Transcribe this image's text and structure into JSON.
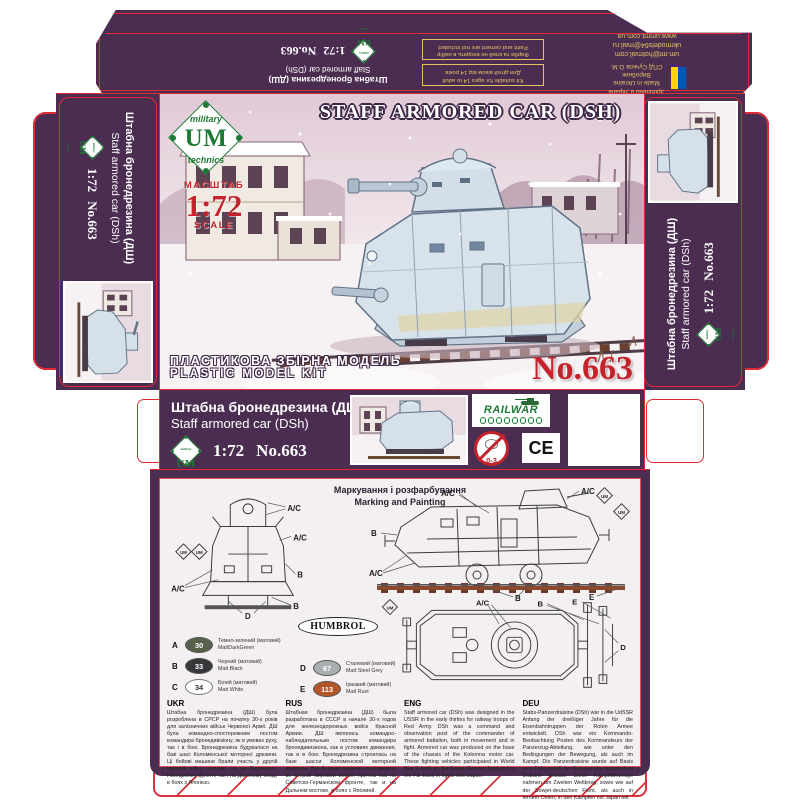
{
  "brand": {
    "military": "military",
    "um": "UM",
    "technics": "technics"
  },
  "top_flap": {
    "title_uk": "Штабна бронедрезина (ДШ)",
    "title_en": "Staff armored car (DSh)",
    "scale": "1:72",
    "kit_no": "No.663",
    "warning_paint_uk": "Фарби та клей не входять в набір",
    "warning_paint_en": "Paint and cement are not included",
    "warning_age_en": "Kit suitable for ages 14 to adult",
    "warning_age_uk": "Для дітей віком від 14 років",
    "email1": "um.mt@hotmail.com",
    "email2": "ukrmodels64@mail.ru",
    "website": "www.ummt.com.ua",
    "made_in_uk": "Зроблено в Україні",
    "made_in_en": "Made in Ukraine",
    "producer_label": "Виробник",
    "producer_name": "СПД Сучков О.М."
  },
  "box_face": {
    "title": "STAFF ARMORED CAR (DSH)",
    "scale_word_uk": "МАСШТАБ",
    "scale": "1:72",
    "scale_word_en": "SCALE",
    "kit_type_uk": "ПЛАСТИКОВА ЗБІРНА МОДЕЛЬ",
    "kit_type_en": "PLASTIC MODEL KIT",
    "kit_no": "No.663"
  },
  "side_panel": {
    "title_uk": "Штабна бронедрезина (ДШ)",
    "title_en": "Staff armored car (DSh)",
    "scale": "1:72",
    "kit_no": "No.663"
  },
  "mid_strip": {
    "title_uk": "Штабна бронедрезина (ДШ)",
    "title_en": "Staff armored car (DSh)",
    "scale": "1:72",
    "kit_no": "No.663",
    "railwar": "RAILWAR",
    "age_mark": "0-3",
    "ce_mark": "CE"
  },
  "marking": {
    "header_uk": "Маркування і розфарбування",
    "header_en": "Marking and Painting",
    "labels": {
      "ac": "A/C",
      "b": "B",
      "d": "D",
      "e": "E"
    },
    "paint_brand": "HUMBROL",
    "colors": [
      {
        "letter": "A",
        "code": "30",
        "hex": "#57624d",
        "name_uk": "Темно-зелений (матовий)",
        "name_en": "MattDarkGreen"
      },
      {
        "letter": "B",
        "code": "33",
        "hex": "#36383b",
        "name_uk": "Чорний (матовий)",
        "name_en": "Matt Black"
      },
      {
        "letter": "C",
        "code": "34",
        "hex": "#ffffff",
        "name_uk": "Білий (матовий)",
        "name_en": "Matt White"
      },
      {
        "letter": "D",
        "code": "67",
        "hex": "#a9aeb1",
        "name_uk": "Сталевий (матовий)",
        "name_en": "Matt Steel Grey"
      },
      {
        "letter": "E",
        "code": "113",
        "hex": "#b4562a",
        "name_uk": "Іржавий (матовий)",
        "name_en": "Matt Rust"
      }
    ]
  },
  "history": {
    "columns": [
      {
        "lang": "UKR",
        "text": "Штабна бронедрезина (ДШ) була розроблена в СРСР на початку 30-х років для залізничних військ Червоної Армії. ДШ була командно-спостережним постом командира бронедивізіону, як в умовах руху, так і в бою. Бронедрезина будувалася на базі шасі Коломенської моторної дрезини. Ці бойові машини брали участь у другій світовій війні, причому як на Радянсько-Німецькому фронті, так і на Далекому сході, в боях з Японією."
      },
      {
        "lang": "RUS",
        "text": "Штабная бронедрезина (ДШ) была разработана в СССР в начале 30-х годов для железнодорожных войск Красной Армии. ДШ являлась командно-наблюдательным постом командира бронедивизиона, как в условиях движения, так и в бою. Бронедрезина строилась на базе шасси Коломенской моторной дрезины. Эти боевые машины участвовали во второй мировой войне, причем как на Советско-Германском фронте, так и на Дальнем востоке, в боях с Японией."
      },
      {
        "lang": "ENG",
        "text": "Staff armored car (DSh) was designed in the USSR in the early thirties for railway troops of Red Army. DSh was a command and observation post of the commander of armored battalion, both in movement and in fight. Armored car was produced on the base of the chassis of the Kolomna motor car. These fighting vehicles participated in World War II, both on the Soviet-German front and in the Far East, in fights with Japan."
      },
      {
        "lang": "DEU",
        "text": "Stabs-Panzerdraisine (DSh) war in die UdSSR Anfang der dreißiger Jahre für die Eisenbahntruppen der Roten Armee entwickelt. DSh war ein Kommando-Beobachtung Posten des Kommandeurs der Panzerzug-Abteilung, wie unter den Bedingungen der Bewegung, als auch im Kampf. Die Panzerdraisine wurde auf Basis vom Fahrgestell der Kolomensky motorischen Draisine gebaut. Diese Kampffahrzeuge nahmen am Zweiten Weltkrieg, sowie wie auf der Sowjet-deutschen Front, als auch in fernem Osten, in den Kämpfen mit Japan teil."
      }
    ]
  },
  "colors": {
    "purple": "#4a2d51",
    "cut_line": "#e02b35",
    "accent_red": "#c4232b",
    "warn_yellow": "#e6c063",
    "brand_green": "#1d7a35",
    "flag_blue": "#0057b7",
    "flag_yellow": "#ffd700",
    "rail_brown": "#8a4a2e"
  }
}
